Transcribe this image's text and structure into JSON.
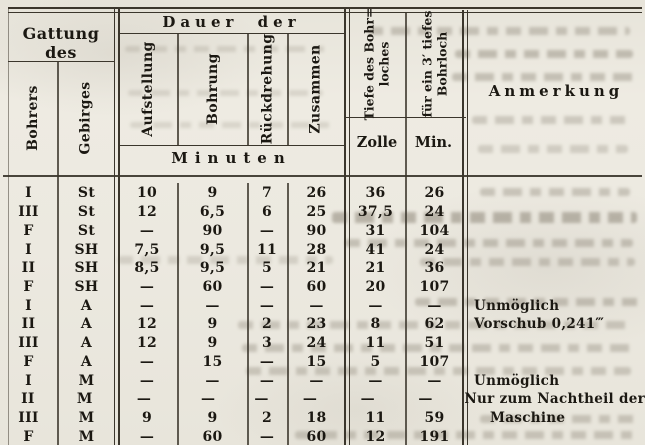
{
  "colors": {
    "paper": "#ECE9E0",
    "ink": "#1B1812",
    "rule": "#3B362C",
    "bleedthrough": "#8D8678"
  },
  "table": {
    "group_headers": {
      "gattung": "Gattung des",
      "dauer": "Dauer der",
      "anmerkung": "Anmerkung"
    },
    "rotated_columns": [
      "Bohrers",
      "Gebirges",
      "Aufstellung",
      "Bohrung",
      "Rückdrehung",
      "Zusammen"
    ],
    "depth_col": {
      "line1": "Tiefe des Bohr=",
      "line2": "loches",
      "unit": "Zolle"
    },
    "per3_col": {
      "line1": "für ein 3′ tiefes",
      "line2": "Bohrloch",
      "unit": "Min."
    },
    "unit_row": "Minuten",
    "rows": [
      {
        "bohrer": "I",
        "gebirge": "St",
        "auf": "10",
        "bohr": "9",
        "rueck": "7",
        "zus": "26",
        "zolle": "36",
        "min": "26",
        "anm": ""
      },
      {
        "bohrer": "III",
        "gebirge": "St",
        "auf": "12",
        "bohr": "6,5",
        "rueck": "6",
        "zus": "25",
        "zolle": "37,5",
        "min": "24",
        "anm": ""
      },
      {
        "bohrer": "F",
        "gebirge": "St",
        "auf": "—",
        "bohr": "90",
        "rueck": "—",
        "zus": "90",
        "zolle": "31",
        "min": "104",
        "anm": ""
      },
      {
        "bohrer": "I",
        "gebirge": "SH",
        "auf": "7,5",
        "bohr": "9,5",
        "rueck": "11",
        "zus": "28",
        "zolle": "41",
        "min": "24",
        "anm": ""
      },
      {
        "bohrer": "II",
        "gebirge": "SH",
        "auf": "8,5",
        "bohr": "9,5",
        "rueck": "5",
        "zus": "21",
        "zolle": "21",
        "min": "36",
        "anm": ""
      },
      {
        "bohrer": "F",
        "gebirge": "SH",
        "auf": "—",
        "bohr": "60",
        "rueck": "—",
        "zus": "60",
        "zolle": "20",
        "min": "107",
        "anm": ""
      },
      {
        "bohrer": "I",
        "gebirge": "A",
        "auf": "—",
        "bohr": "—",
        "rueck": "—",
        "zus": "—",
        "zolle": "—",
        "min": "—",
        "anm": "Unmöglich"
      },
      {
        "bohrer": "II",
        "gebirge": "A",
        "auf": "12",
        "bohr": "9",
        "rueck": "2",
        "zus": "23",
        "zolle": "8",
        "min": "62",
        "anm": "Vorschub 0,241‴"
      },
      {
        "bohrer": "III",
        "gebirge": "A",
        "auf": "12",
        "bohr": "9",
        "rueck": "3",
        "zus": "24",
        "zolle": "11",
        "min": "51",
        "anm": ""
      },
      {
        "bohrer": "F",
        "gebirge": "A",
        "auf": "—",
        "bohr": "15",
        "rueck": "—",
        "zus": "15",
        "zolle": "5",
        "min": "107",
        "anm": ""
      },
      {
        "bohrer": "I",
        "gebirge": "M",
        "auf": "—",
        "bohr": "—",
        "rueck": "—",
        "zus": "—",
        "zolle": "—",
        "min": "—",
        "anm": "Unmöglich"
      },
      {
        "bohrer": "II",
        "gebirge": "M",
        "auf": "—",
        "bohr": "—",
        "rueck": "—",
        "zus": "—",
        "zolle": "—",
        "min": "—",
        "anm": "Nur zum Nachtheil der"
      },
      {
        "bohrer": "III",
        "gebirge": "M",
        "auf": "9",
        "bohr": "9",
        "rueck": "2",
        "zus": "18",
        "zolle": "11",
        "min": "59",
        "anm": "Maschine",
        "anm_indent": true
      },
      {
        "bohrer": "F",
        "gebirge": "M",
        "auf": "—",
        "bohr": "60",
        "rueck": "—",
        "zus": "60",
        "zolle": "12",
        "min": "191",
        "anm": ""
      }
    ]
  }
}
